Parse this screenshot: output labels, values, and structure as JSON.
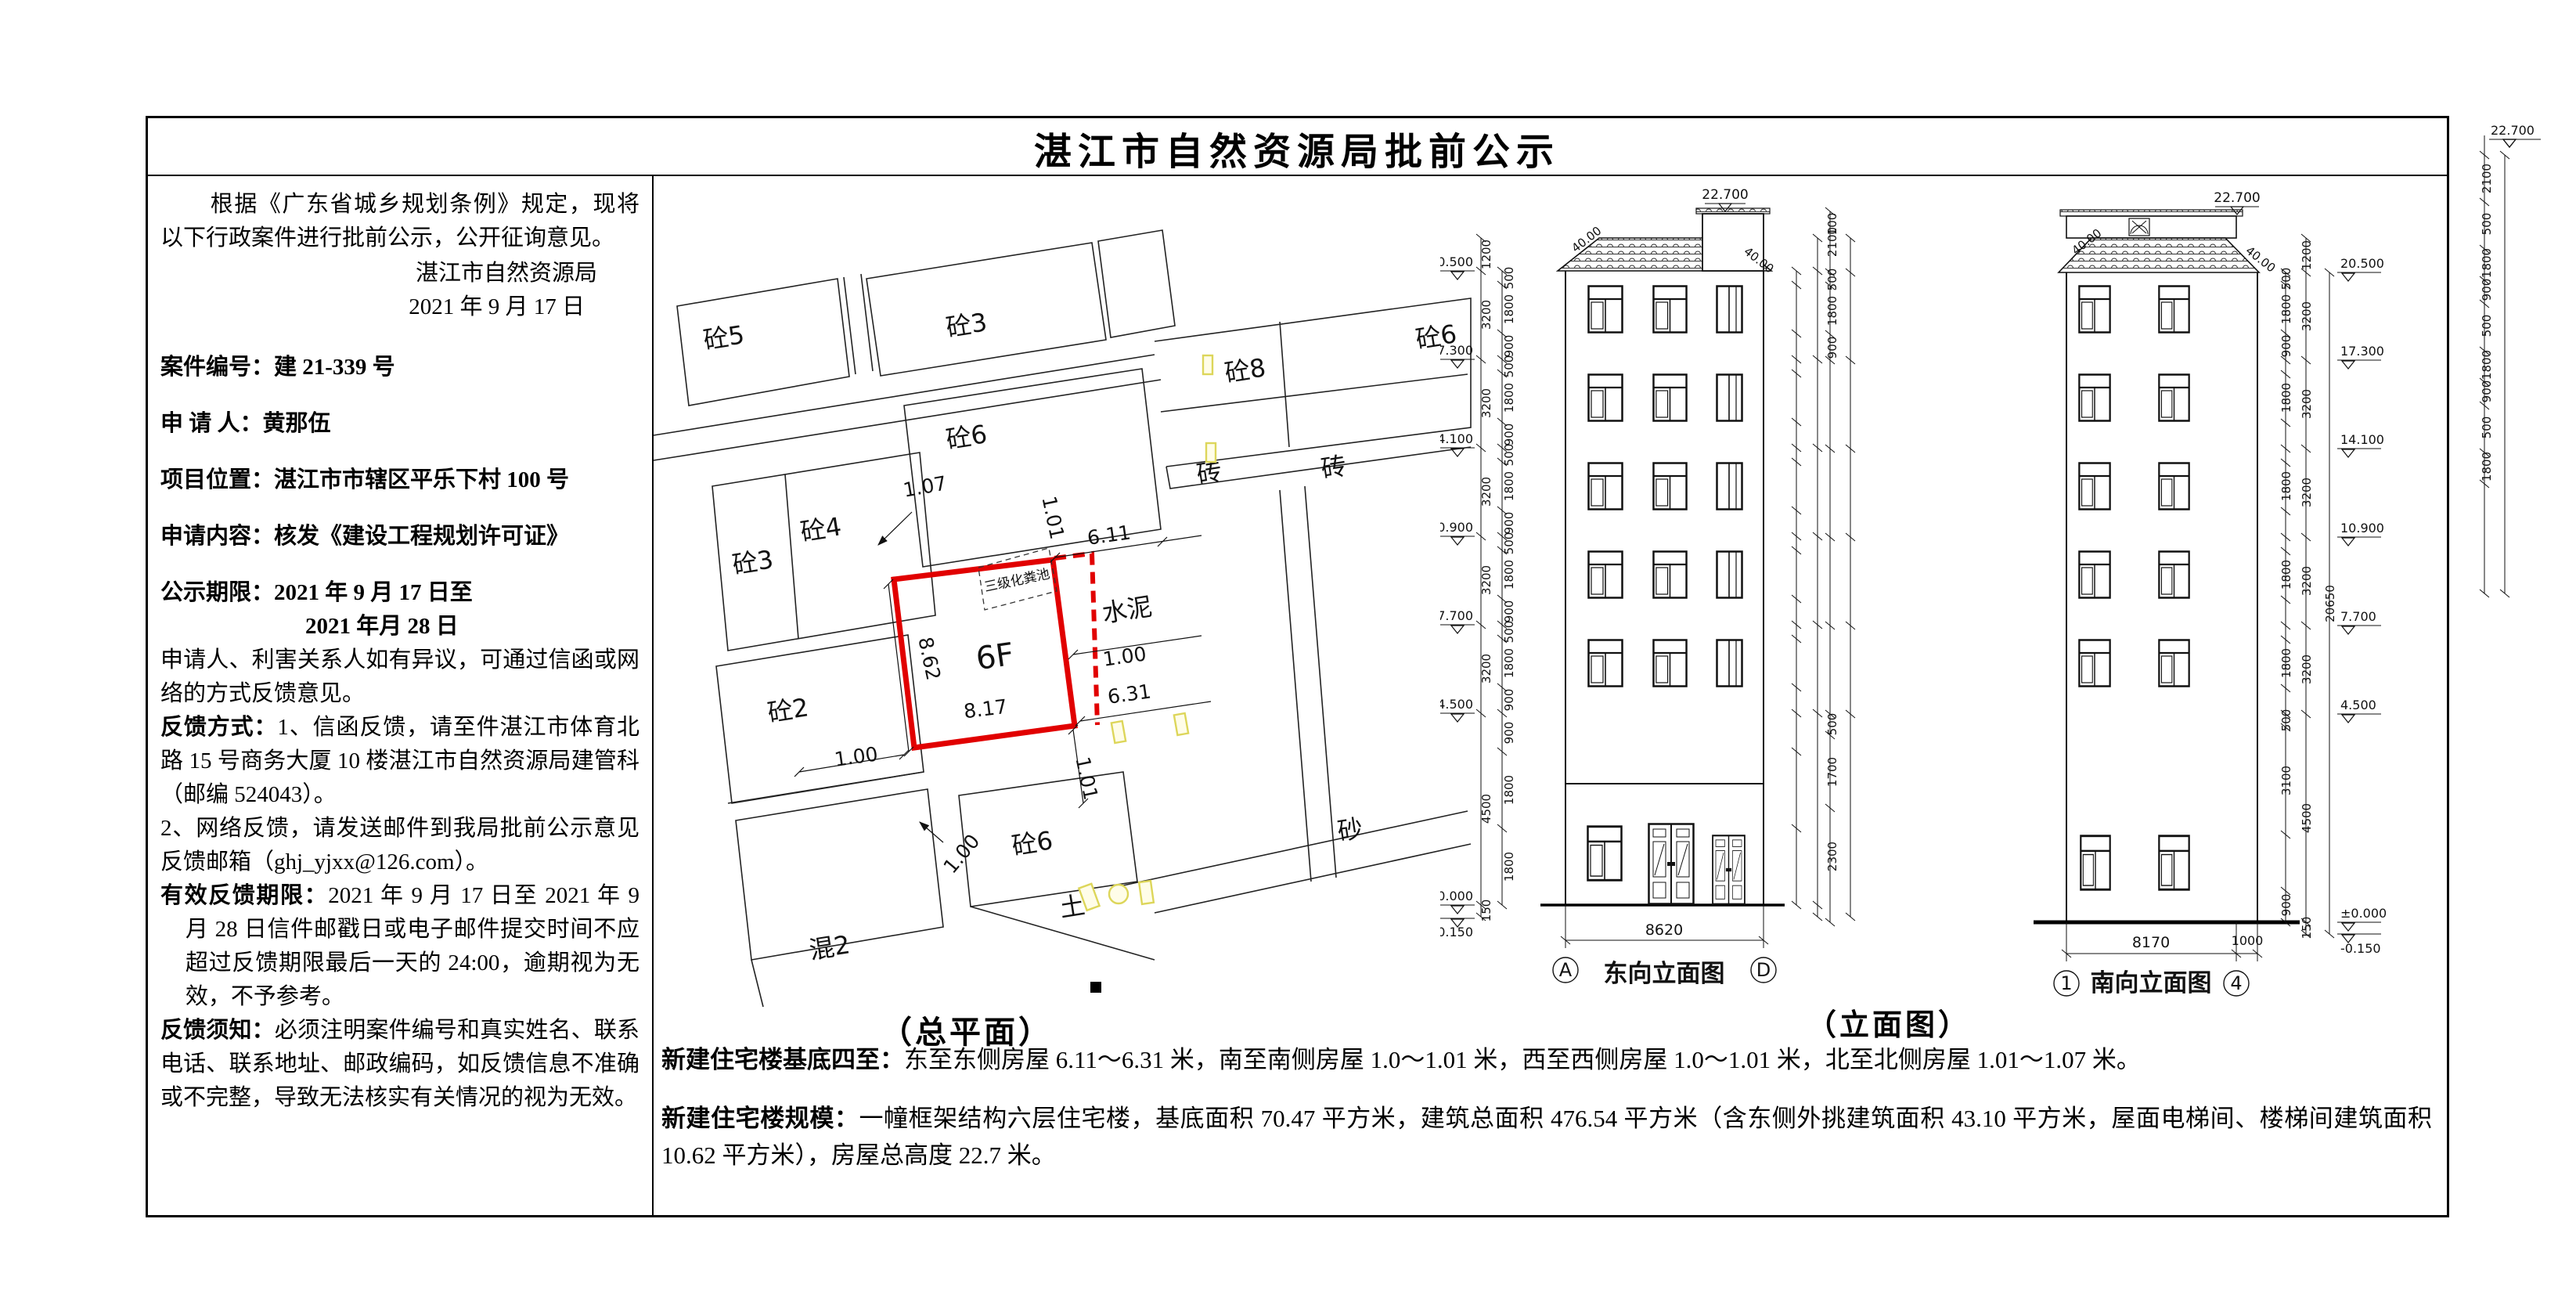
{
  "title": "湛江市自然资源局批前公示",
  "left_panel": {
    "intro": "根据《广东省城乡规划条例》规定，现将以下行政案件进行批前公示，公开征询意见。",
    "signature": {
      "org": "湛江市自然资源局",
      "date": "2021 年 9 月 17 日"
    },
    "case_no_label": "案件编号：",
    "case_no": "建 21-339 号",
    "applicant_label": "申 请 人：",
    "applicant": "黄那伍",
    "location_label": "项目位置：",
    "location": "湛江市市辖区平乐下村 100 号",
    "content_label": "申请内容：",
    "content": "核发《建设工程规划许可证》",
    "period_label": "公示期限：",
    "period_line1": "2021 年 9 月 17 日至",
    "period_line2": "2021 年月 28 日",
    "objection": "申请人、利害关系人如有异议，可通过信函或网络的方式反馈意见。",
    "feedback_label": "反馈方式：",
    "feedback_1": "1、信函反馈，请至件湛江市体育北路 15 号商务大厦 10 楼湛江市自然资源局建管科（邮编 524043）。",
    "feedback_2": "2、网络反馈，请发送邮件到我局批前公示意见反馈邮箱（ghj_yjxx@126.com）。",
    "valid_label": "有效反馈期限：",
    "valid_text": "2021 年 9 月 17 日至 2021 年 9 月 28 日信件邮戳日或电子邮件提交时间不应超过反馈期限最后一天的 24:00，逾期视为无效，不予参考。",
    "notice_label": "反馈须知：",
    "notice_text": "必须注明案件编号和真实姓名、联系电话、联系地址、邮政编码，如反馈信息不准确或不完整，导致无法核实有关情况的视为无效。"
  },
  "captions": {
    "site": "（总平面）",
    "elev": "（立面图）"
  },
  "site_plan": {
    "labels": [
      "砼5",
      "砼3",
      "砼8",
      "砖",
      "砖",
      "砼6",
      "砼6",
      "砼4",
      "砼3",
      "砼2",
      "混2",
      "砼6",
      "土",
      "砂",
      "水泥"
    ],
    "dims": [
      "1.07",
      "1.01",
      "6.11",
      "1.00",
      "6.31",
      "8.62",
      "8.17",
      "1.00",
      "1.00",
      "1.01"
    ],
    "plot_floors": "6F",
    "septic_tank": "三级化粪池",
    "plot_color": "#e10000",
    "marker_color": "#ddd65a"
  },
  "elev_east": {
    "caption": "东向立面图",
    "axis_left": "A",
    "axis_right": "D",
    "width_dim": "8620",
    "top_level": "22.700",
    "roof_angle": "40.00",
    "levels": [
      "20.500",
      "17.300",
      "14.100",
      "10.900",
      "7.700",
      "4.500",
      "±0.000",
      "-0.150"
    ],
    "floor_dims": [
      "1200",
      "3200",
      "3200",
      "3200",
      "3200",
      "3200",
      "4500",
      "150"
    ],
    "sub_dims": [
      "500",
      "1800",
      "900"
    ],
    "ground_dims": [
      "900",
      "1800",
      "1800"
    ]
  },
  "elev_south": {
    "caption": "南向立面图",
    "axis_left": "1",
    "axis_right": "4",
    "width_dim": "8170",
    "overhang_dim": "1000",
    "top_level": "22.700",
    "roof_angle": "40.00",
    "levels": [
      "20.500",
      "17.300",
      "14.100",
      "10.900",
      "7.700",
      "4.500",
      "±0.000",
      "-0.150"
    ],
    "floor_dims": [
      "1200",
      "3200",
      "3200",
      "3200",
      "3200",
      "3200",
      "4500",
      "150"
    ],
    "sub_dims": [
      "500",
      "1800",
      "900"
    ],
    "left_top_dims": [
      "100",
      "2100"
    ],
    "left_ground_dims": [
      "500",
      "1700",
      "2300"
    ],
    "ground_dims": [
      "500",
      "3100",
      "900"
    ],
    "overall_dim": "20650"
  },
  "overflow_chain": {
    "top_level": "22.700",
    "dims": [
      "2100",
      "500",
      "1800",
      "900",
      "500",
      "1800",
      "900",
      "500",
      "1800"
    ]
  },
  "bottom": {
    "extent_label": "新建住宅楼基底四至：",
    "extent_text": "东至东侧房屋 6.11～6.31 米，南至南侧房屋 1.0～1.01 米，西至西侧房屋 1.0～1.01 米，北至北侧房屋 1.01～1.07 米。",
    "scale_label": "新建住宅楼规模：",
    "scale_text": "一幢框架结构六层住宅楼，基底面积 70.47 平方米，建筑总面积 476.54 平方米（含东侧外挑建筑面积 43.10 平方米，屋面电梯间、楼梯间建筑面积 10.62 平方米），房屋总高度 22.7 米。"
  }
}
